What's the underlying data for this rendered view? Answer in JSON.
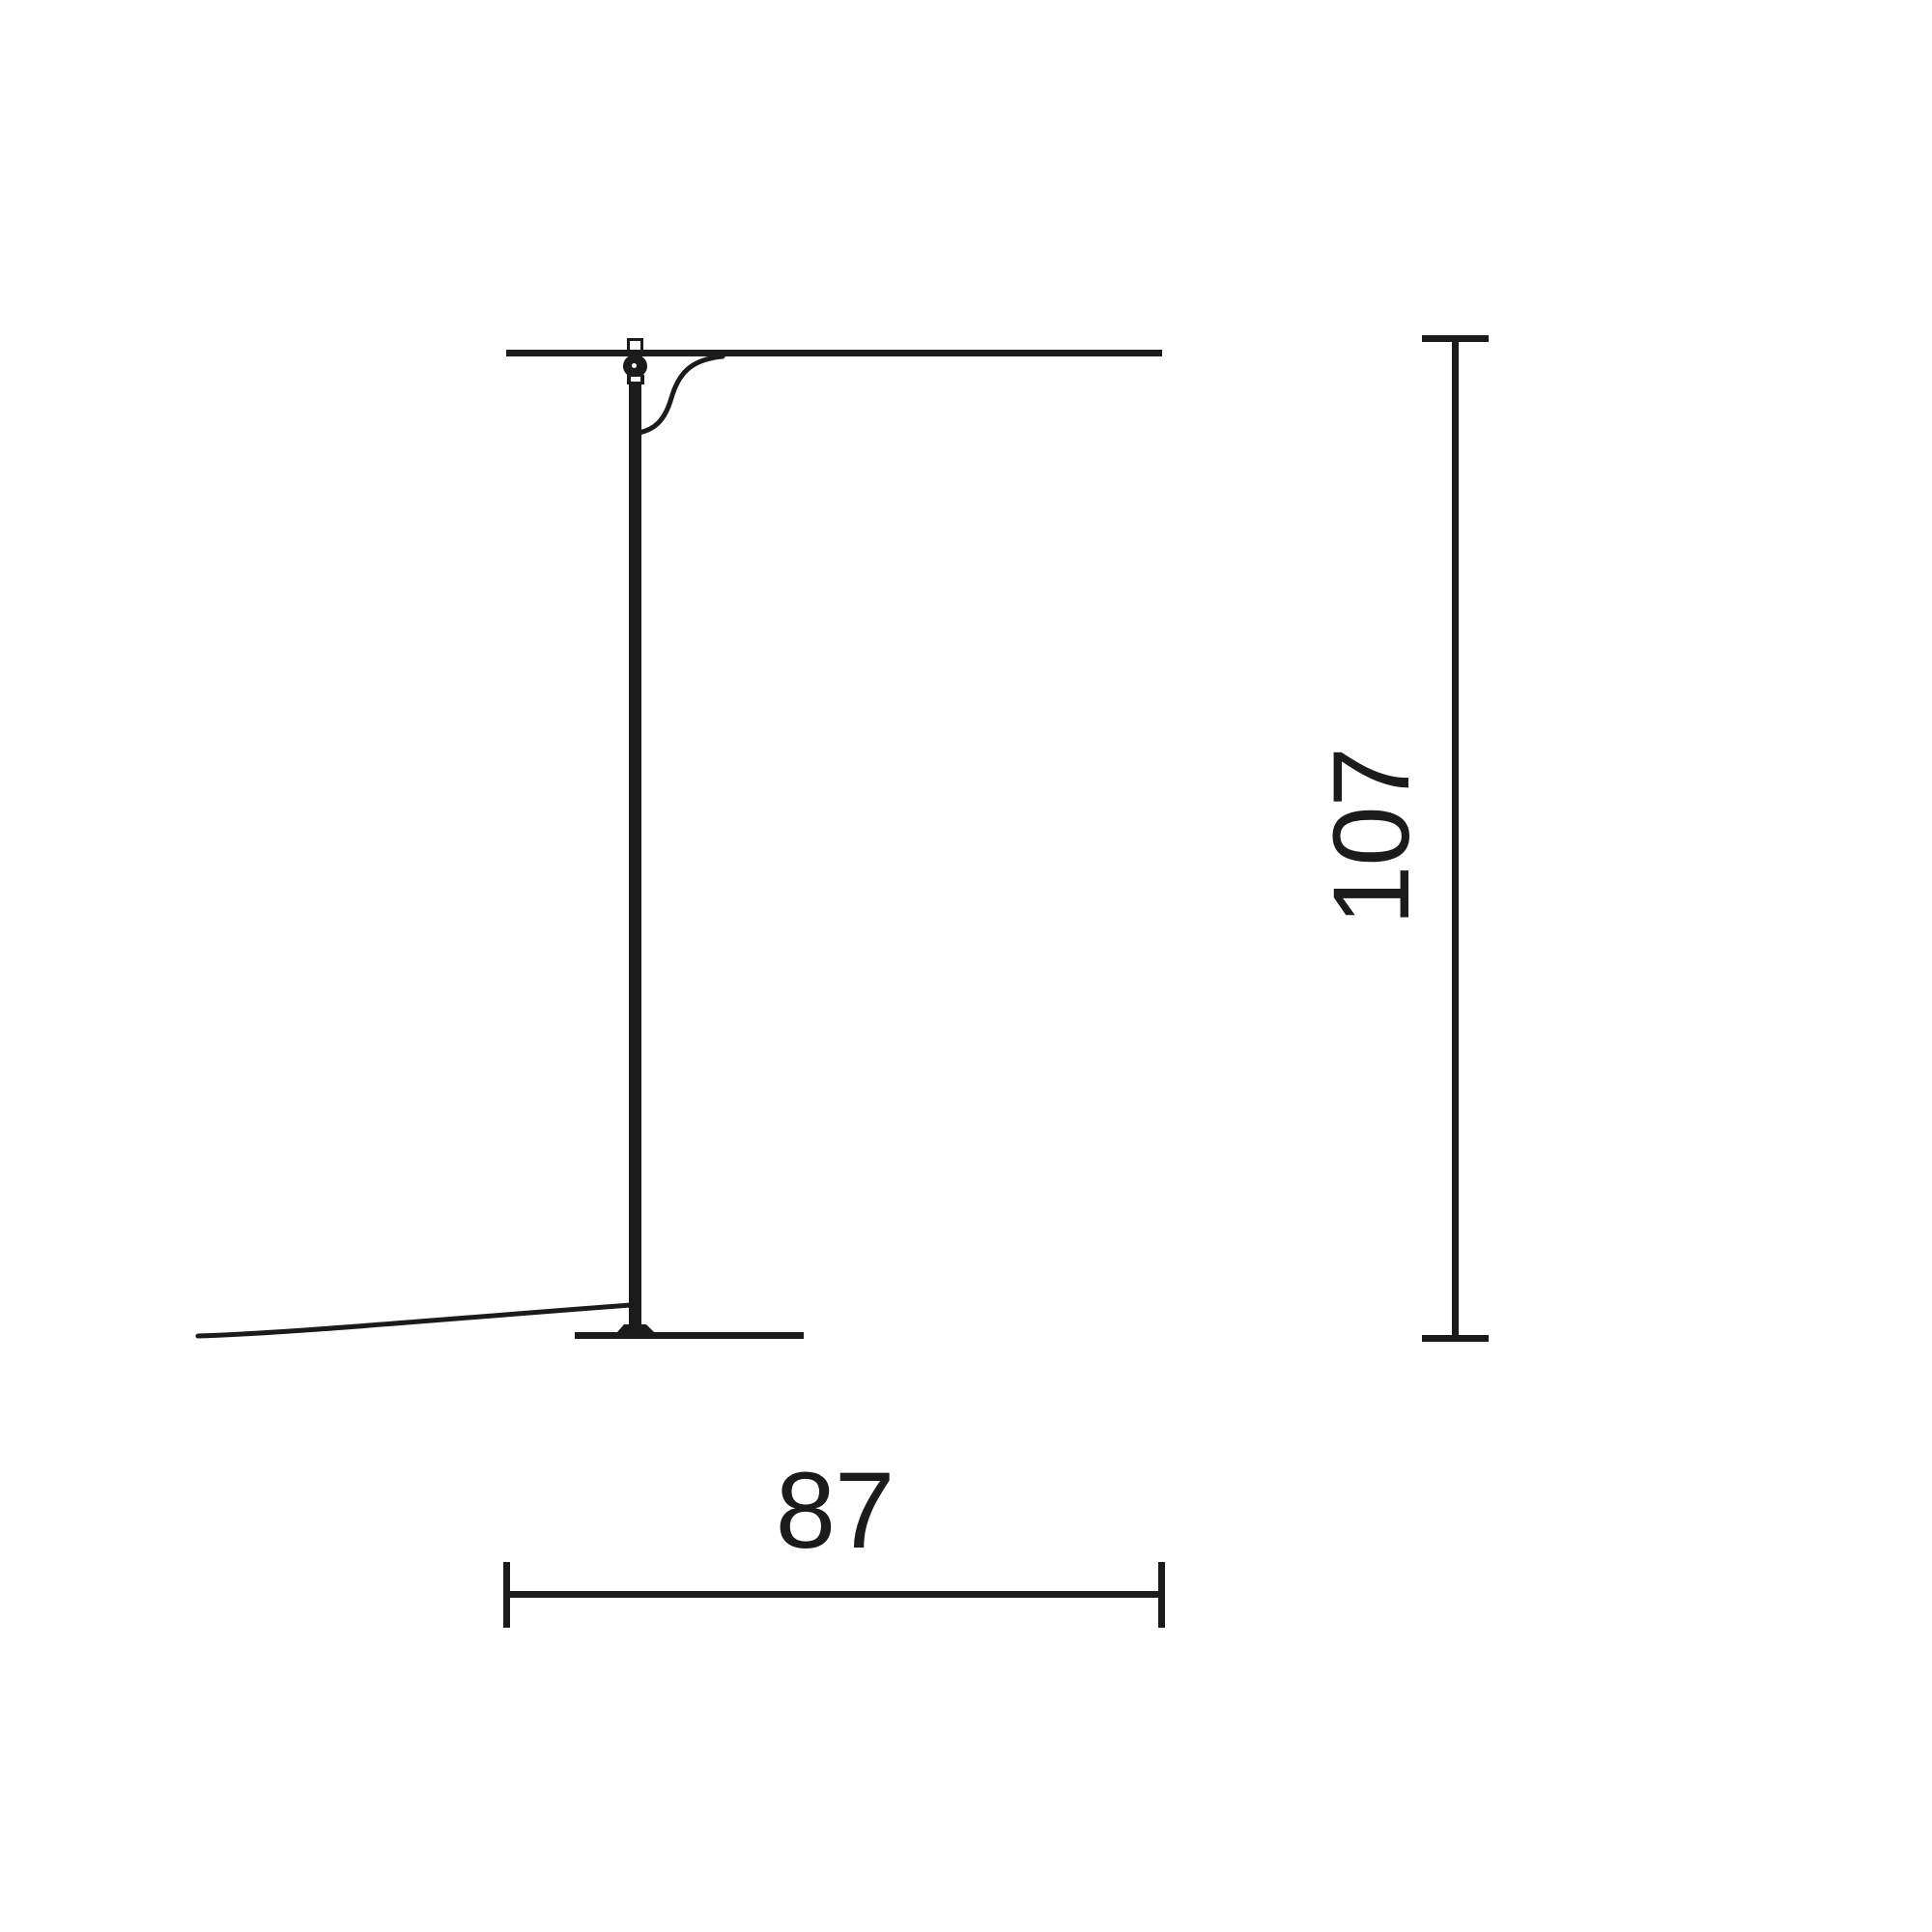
{
  "drawing": {
    "ink_color": "#1b1b1b",
    "background_color": "#ffffff",
    "dimensions": {
      "height": {
        "value": "107"
      },
      "width": {
        "value": "87"
      }
    }
  }
}
